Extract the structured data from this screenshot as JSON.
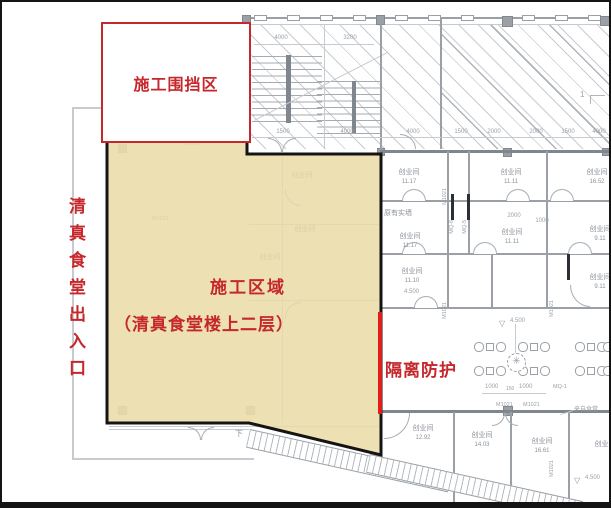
{
  "annotations": {
    "enclosure_label": "施工围挡区",
    "zone_title": "施工区域",
    "zone_subtitle": "（清真食堂楼上二层）",
    "entrance_label": "清真食堂出入口",
    "barrier_label": "隔离防护"
  },
  "colors": {
    "annotation_red": "#c5272b",
    "barrier_red": "#e31c1c",
    "zone_fill": "#e9daa4",
    "zone_border": "#141414",
    "plan_line": "#9aa0a6"
  },
  "plan": {
    "rooms": [
      {
        "name": "创业间",
        "area": "11.17"
      },
      {
        "name": "创业间",
        "area": "11.11"
      },
      {
        "name": "创业间",
        "area": "16.52"
      },
      {
        "name": "创业间",
        "area": "11.17"
      },
      {
        "name": "创业间",
        "area": "11.11"
      },
      {
        "name": "创业间",
        "area": "9.11"
      },
      {
        "name": "创业间",
        "area": "11.10"
      },
      {
        "name": "创业间",
        "area": "9.11"
      },
      {
        "name": "创业间",
        "area": "12.92"
      },
      {
        "name": "创业间",
        "area": "14.03"
      },
      {
        "name": "创业间",
        "area": "16.61"
      },
      {
        "name": "创业间",
        "area": ""
      }
    ],
    "faint_rooms": [
      "创业间",
      "创业间",
      "创业间"
    ],
    "wall_labels": {
      "existing_wall": "原有实墙",
      "mq1": "MQ-1",
      "mq5": "MQ-5",
      "mq6": "MQ-6",
      "m1021": "M1021"
    },
    "levels": {
      "v1": "4.500",
      "v2": "4.500",
      "v3": "4.500"
    },
    "dims": {
      "top": [
        "4000",
        "3200"
      ],
      "mid": [
        "1500",
        "4000",
        "4000",
        "1500",
        "2000",
        "2000",
        "1500",
        "4000"
      ],
      "room": [
        "2000",
        "1000"
      ],
      "dining": [
        "1000",
        "150",
        "1000"
      ]
    },
    "stair_down_label": "下",
    "grid_bubble": "1",
    "note_right": "来自食堂"
  }
}
